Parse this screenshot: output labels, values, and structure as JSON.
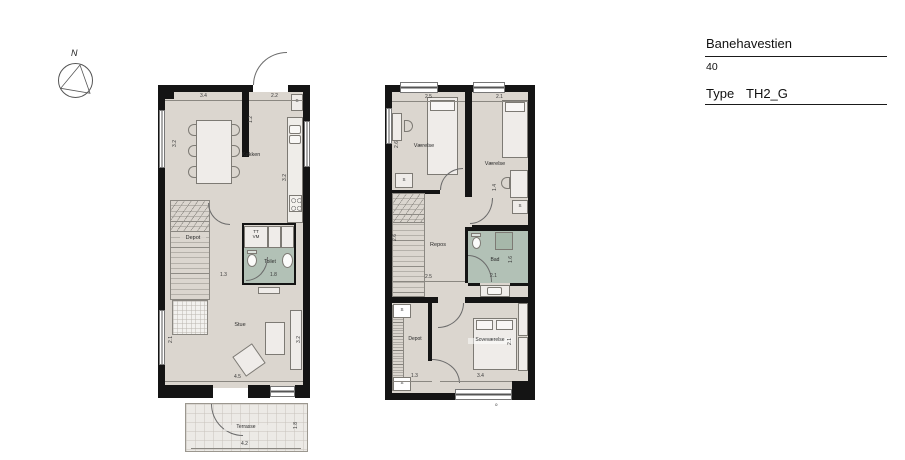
{
  "title_block": {
    "project": "Banehavestien",
    "unit_number": "40",
    "type_label": "Type",
    "type_value": "TH2_G"
  },
  "compass": {
    "north_label": "N"
  },
  "colors": {
    "wall": "#141414",
    "floor": "#dbd6cf",
    "wet": "#b2c1b6",
    "terrace": "#eceae6"
  },
  "ground_floor": {
    "room_labels": {
      "kitchen": "Køkken",
      "under_stairs": "Depot",
      "washer_line1": "TT",
      "washer_line2": "VM",
      "toilet": "Toilet",
      "living": "Stue",
      "terrace": "Terrasse",
      "closet": "S"
    },
    "dimensions": {
      "dining_width": "3.4",
      "entry_width": "2.2",
      "entry_depth": "1.2",
      "dining_depth": "3.2",
      "kitchen_length": "3.2",
      "hall_width": "1.3",
      "toilet_width": "1.8",
      "living_width": "4.5",
      "living_depth": "3.2",
      "living_window": "2.1",
      "terrace_width": "4.2",
      "terrace_depth": "1.8"
    }
  },
  "first_floor": {
    "room_labels": {
      "bedroom_left": "Værelse",
      "bedroom_right": "Værelse",
      "landing": "Repos",
      "bath": "Bad",
      "storage": "Depot",
      "master_bedroom": "Soveværelse",
      "closet": "S"
    },
    "dimensions": {
      "bedroom_left_width": "2.5",
      "bedroom_right_width": "2.1",
      "bedroom_left_depth": "2.6",
      "stair_depth": "2.6",
      "landing_width": "2.5",
      "bath_width": "2.1",
      "bath_depth": "1.6",
      "bedroom_right_inner": "1.4",
      "storage_width": "1.3",
      "master_width": "3.4",
      "master_depth": "2.1"
    },
    "section_marker": "o"
  }
}
